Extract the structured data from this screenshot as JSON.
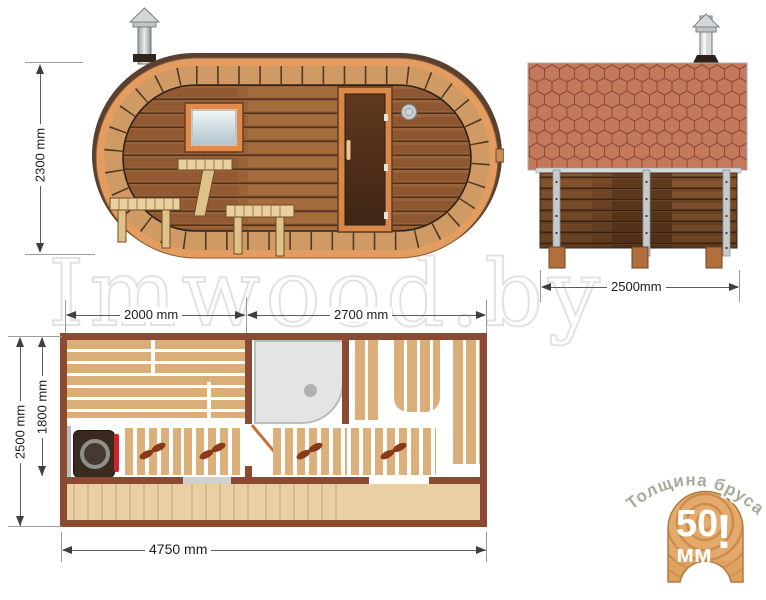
{
  "watermark": {
    "text": "Imwood.by"
  },
  "side_view": {
    "height_label": "2300 mm"
  },
  "end_view": {
    "width_label": "2500mm"
  },
  "floor_plan": {
    "section_left_label": "2000 mm",
    "section_right_label": "2700 mm",
    "outer_width_label": "2500 mm",
    "inner_width_label": "1800 mm",
    "length_label": "4750 mm"
  },
  "badge": {
    "arc_label": "Толщина бруса",
    "value": "50",
    "unit": "мм",
    "exclaim": "!"
  },
  "colors": {
    "wall_maroon": "#8d4a33",
    "bench_tan": "#d9ae79",
    "rim_orange": "#e49d60",
    "interior_brown": "#9a6238",
    "roof_terracotta": "#c4785c",
    "stove_red": "#d2232a",
    "shower_gray": "#e3e5e5",
    "dim_line": "#5c5c5c"
  }
}
